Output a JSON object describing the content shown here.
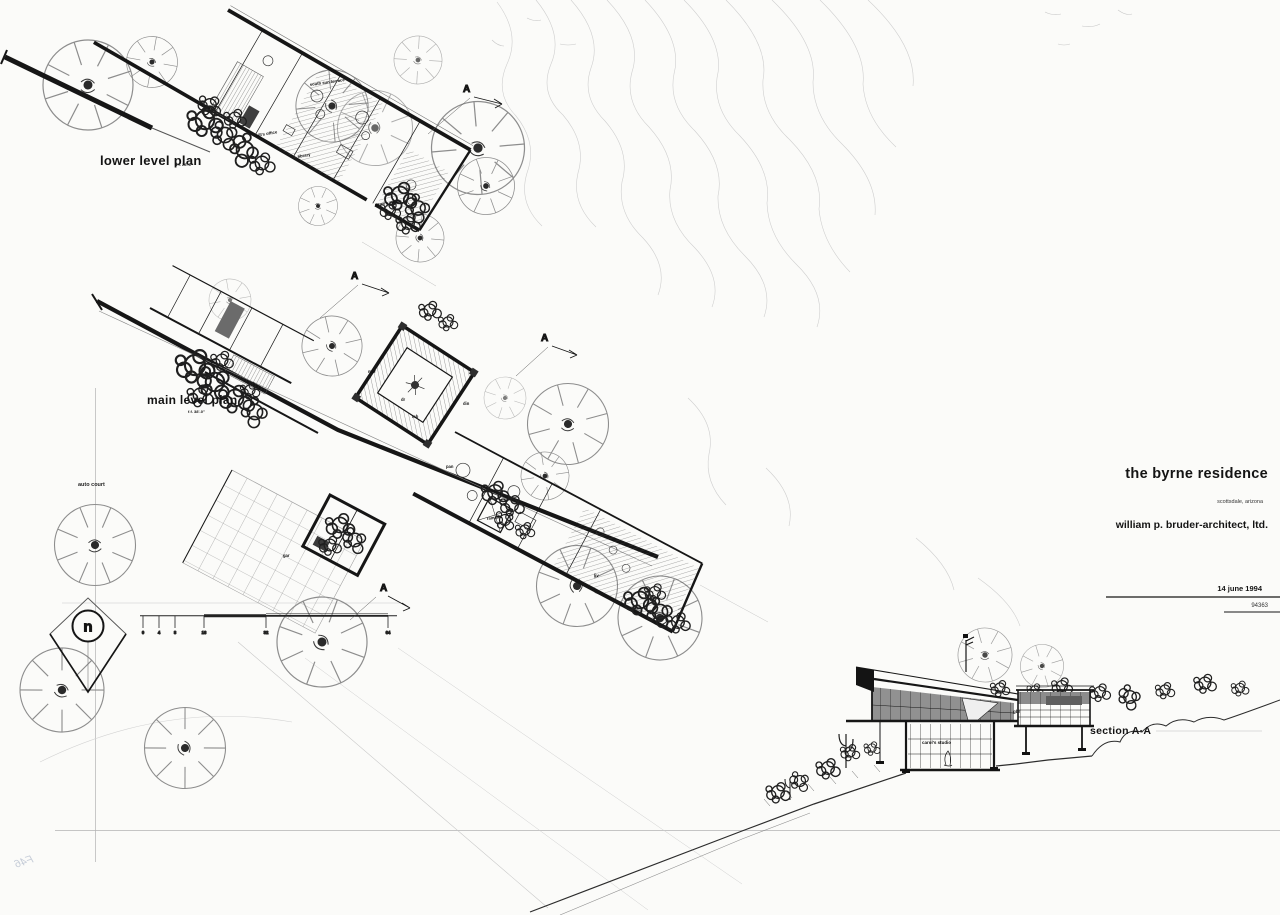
{
  "title_block": {
    "project": "the byrne residence",
    "location": "scottsdale, arizona",
    "architect": "william p. bruder-architect, ltd.",
    "date": "14 june 1994",
    "job_number": "94363"
  },
  "plan_titles": {
    "lower_level": "lower level plan",
    "lower_level_elevation": "f.f. 28'-0\"",
    "main_level": "main level plan",
    "main_level_elevation": "f.f. 38'-0\"",
    "section": "section A·A"
  },
  "drawing_labels": {
    "auto_court": "auto court",
    "north_letter": "n",
    "section_cut_letter": "A"
  },
  "room_labels": {
    "lower": [
      {
        "text": "south sun terrace",
        "x": 310,
        "y": 86,
        "size": 4.2,
        "rotate": -8
      },
      {
        "text": "bill's office",
        "x": 256,
        "y": 137,
        "size": 4.2,
        "rotate": -10
      },
      {
        "text": "library",
        "x": 298,
        "y": 158,
        "size": 4.2,
        "rotate": -10
      },
      {
        "text": "carol's studio",
        "x": 375,
        "y": 206,
        "size": 4.2,
        "rotate": -8
      }
    ],
    "main": [
      {
        "text": "mbr",
        "x": 368,
        "y": 373,
        "size": 4.2
      },
      {
        "text": "dr",
        "x": 401,
        "y": 401,
        "size": 4.2
      },
      {
        "text": "mb",
        "x": 412,
        "y": 418,
        "size": 4.2
      },
      {
        "text": "din",
        "x": 463,
        "y": 405,
        "size": 4.2
      },
      {
        "text": "pan",
        "x": 446,
        "y": 468,
        "size": 4.2
      },
      {
        "text": "ramada",
        "x": 487,
        "y": 520,
        "size": 4.2,
        "rotate": -8
      },
      {
        "text": "gar",
        "x": 283,
        "y": 557,
        "size": 4.2
      },
      {
        "text": "liv",
        "x": 594,
        "y": 577,
        "size": 4.2
      }
    ],
    "section": [
      {
        "text": "carol's studio",
        "x": 922,
        "y": 744,
        "size": 4.5
      },
      {
        "text": "gbr",
        "x": 1013,
        "y": 713,
        "size": 4.5
      }
    ]
  },
  "scale_bar": {
    "tick_labels": [
      "0",
      "4",
      "8",
      "16",
      "32",
      "64"
    ]
  },
  "annotations": {
    "handwritten_mark": "F46"
  }
}
